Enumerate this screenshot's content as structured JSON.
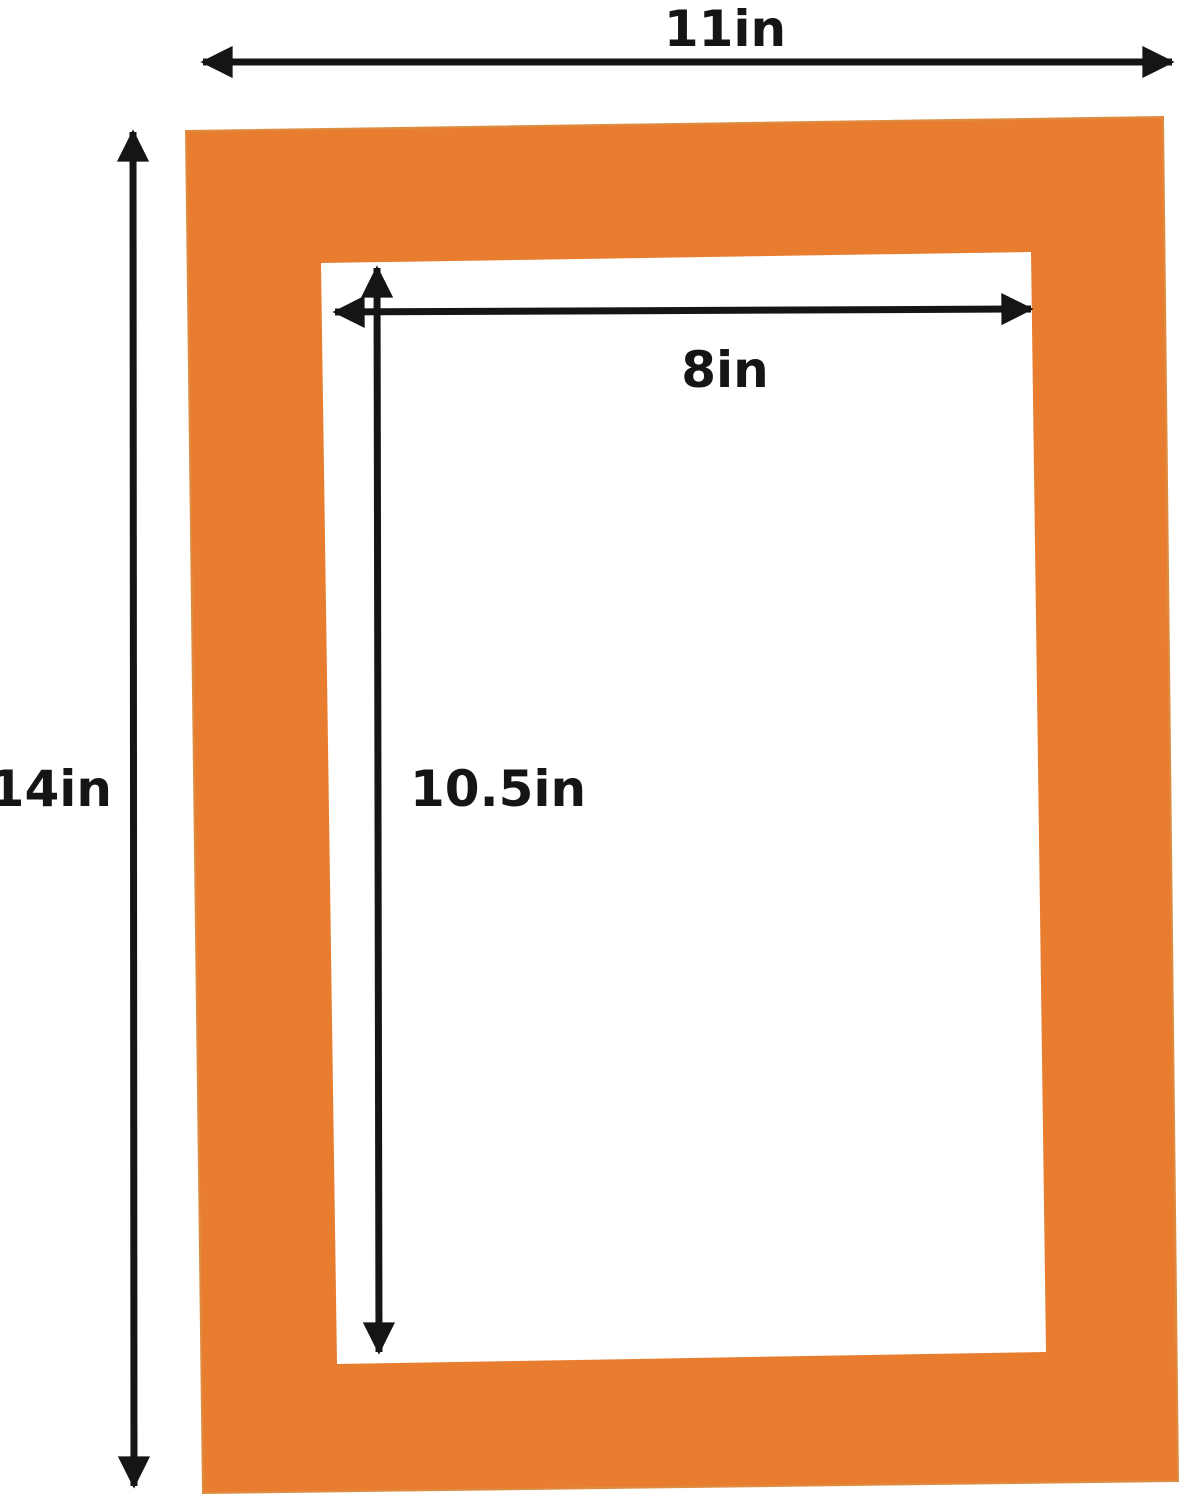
{
  "colors": {
    "mat": "#e87d30",
    "mat_edge": "#dd8c42",
    "opening": "#ffffff",
    "dimension_lines": "#151515",
    "label_text": "#151515",
    "background": "#ffffff"
  },
  "dimensions": {
    "outer_width": "11in",
    "outer_height": "14in",
    "opening_width": "8in",
    "opening_height": "10.5in"
  }
}
